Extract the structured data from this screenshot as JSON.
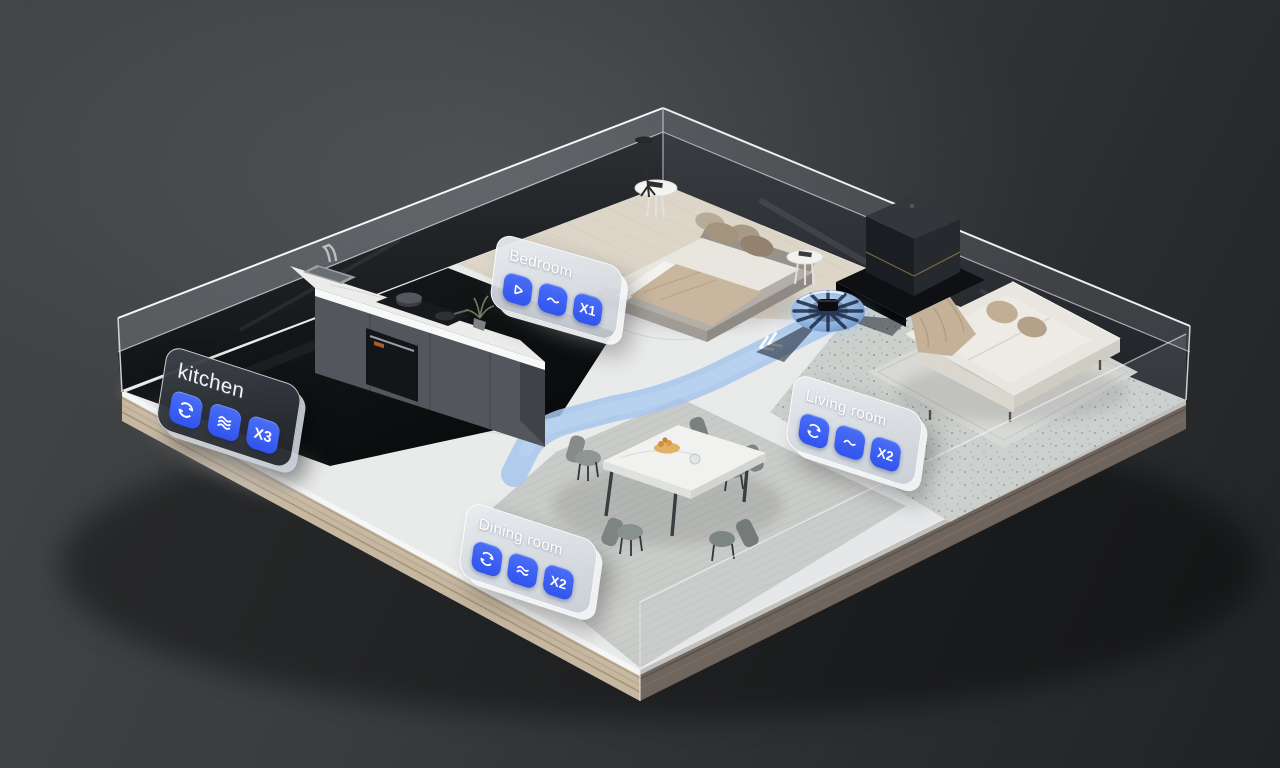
{
  "scene": {
    "type": "smart-home-3d-floorplan-render",
    "objects": [
      "robot-vacuum",
      "charging-dock",
      "cleaning-path",
      "bed",
      "nightstands",
      "floor-lamp",
      "kitchen-island",
      "dining-table",
      "dining-chairs",
      "sofa",
      "area-rug",
      "glass-walls"
    ]
  },
  "cards": [
    {
      "label": "kitchen",
      "badge": "X3",
      "theme": "dark",
      "icons": [
        "cyclone-icon",
        "waves-3-icon",
        "count-badge"
      ]
    },
    {
      "label": "Bedroom",
      "badge": "X1",
      "theme": "light",
      "icons": [
        "triangle-icon",
        "wave-1-icon",
        "count-badge"
      ]
    },
    {
      "label": "Living room",
      "badge": "X2",
      "theme": "light",
      "icons": [
        "cyclone-icon",
        "wave-1-icon",
        "count-badge"
      ]
    },
    {
      "label": "Dining room",
      "badge": "X2",
      "theme": "light",
      "icons": [
        "cyclone-icon",
        "waves-2-icon",
        "count-badge"
      ]
    }
  ],
  "colors": {
    "tile_blue": "#3E5EF0",
    "path_blue": "#A8C7ED",
    "card_light": "#DCE1E7",
    "card_dark": "#2C3036",
    "background": "#333537"
  }
}
